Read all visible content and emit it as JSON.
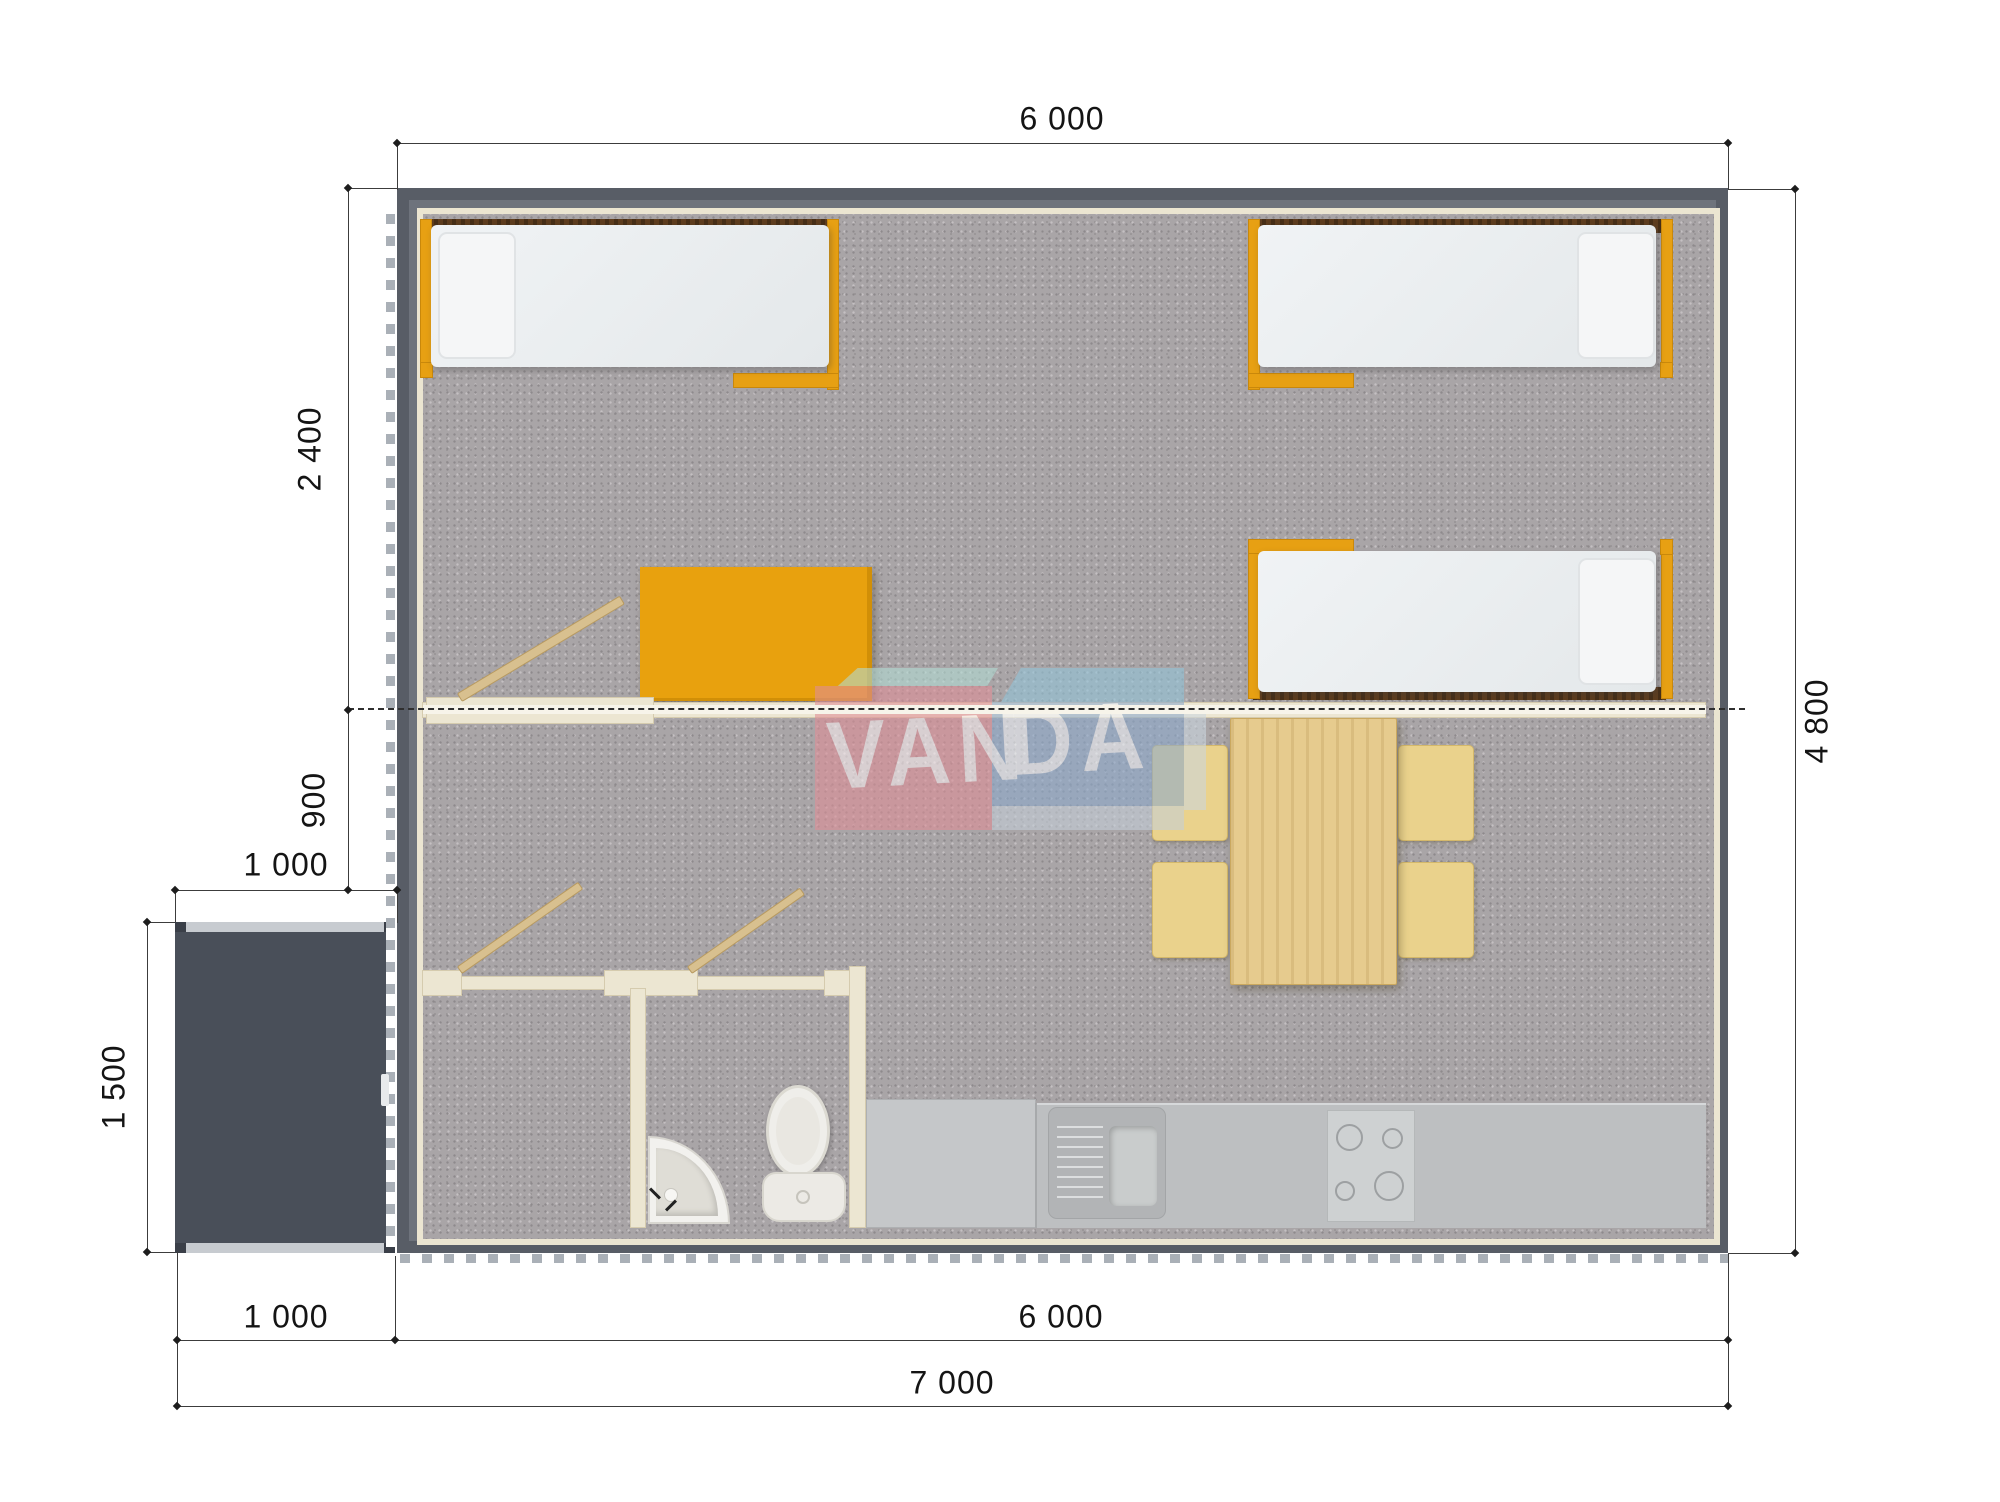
{
  "title": "Modular house floor plan",
  "watermark": {
    "text_left": "VAN",
    "text_right": "DA"
  },
  "dimensions": {
    "top_width": "6 000",
    "right_height": "4 800",
    "left_room_depth": "2 400",
    "left_hall_depth": "900",
    "porch_width_top": "1 000",
    "porch_depth": "1 500",
    "bottom_porch_width": "1 000",
    "bottom_building_width": "6 000",
    "bottom_total_width": "7 000"
  },
  "colors": {
    "wall_dark": "#585d66",
    "accent_orange": "#e8a10e",
    "partition_cream": "#ece6d2",
    "carpet_gray": "#a9a5a7",
    "wood_light": "#e6cb8e",
    "logo_pink": "#e08e97",
    "logo_blue": "#8ca9cc",
    "logo_teal": "#b2dcd4"
  }
}
